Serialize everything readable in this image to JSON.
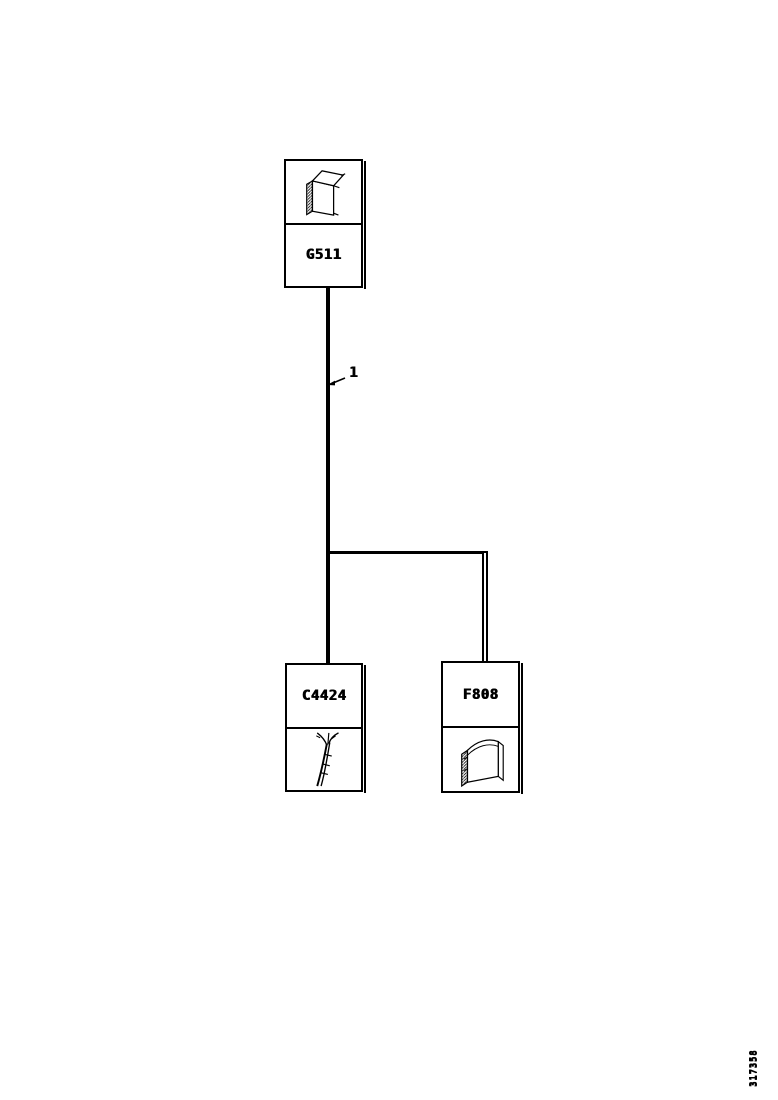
{
  "page": {
    "background": "#ffffff",
    "ink": "#000000",
    "figure_number": "317358"
  },
  "diagram": {
    "wire_label": "1",
    "nodes": [
      {
        "id": "G511",
        "label": "G511",
        "icon": "terminal-component-3d-icon"
      },
      {
        "id": "C4424",
        "label": "C4424",
        "icon": "wire-bundle-icon"
      },
      {
        "id": "F808",
        "label": "F808",
        "icon": "cover-component-3d-icon"
      }
    ]
  }
}
